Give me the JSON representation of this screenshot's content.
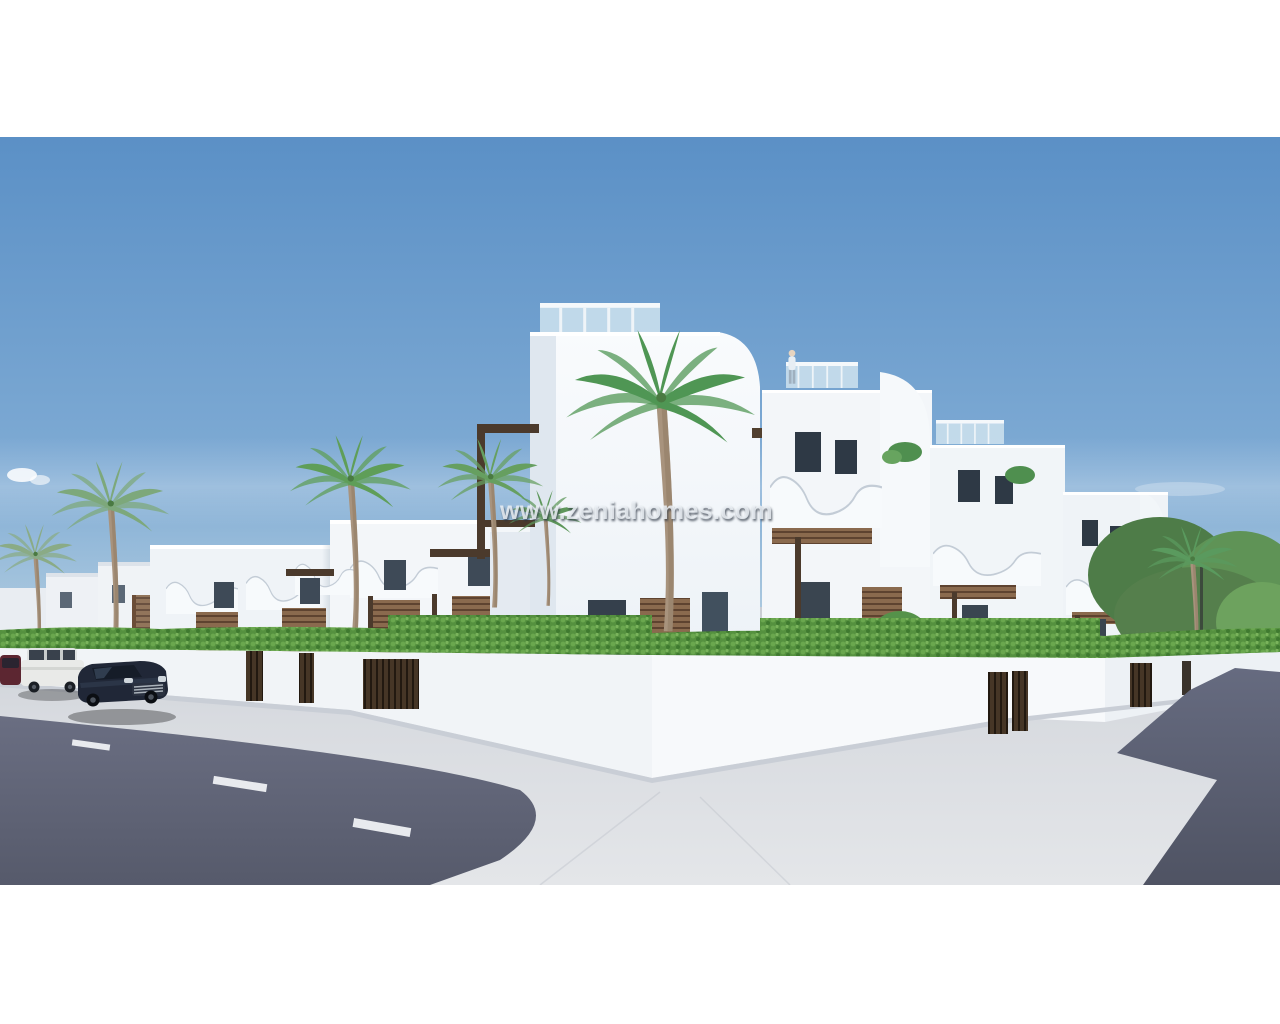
{
  "watermark": {
    "text": "www.zeniahomes.com"
  },
  "photo": {
    "type": "3d-architectural-render",
    "subject": "Modern white Mediterranean apartment complex on a street corner with palm trees, hedge-topped perimeter wall, sidewalks, asphalt roads and parked cars under a clear blue sky",
    "frame_color": "#ffffff"
  },
  "palette": {
    "sky_top": "#5b90c6",
    "sky_horizon": "#b9d2e5",
    "building_white": "#f5f8fb",
    "building_shade": "#dfe6ee",
    "glass_balustrade": "#cfe3ee",
    "wood_slats": "#8a6a4e",
    "pergola_dark": "#4b3a2c",
    "hedge_green": "#55913f",
    "asphalt": "#62667a",
    "sidewalk": "#dadde2",
    "sedan_black": "#202737",
    "suv_white": "#e9eae8",
    "car_maroon": "#5c2631"
  },
  "scene": {
    "elements": [
      "sky",
      "clouds",
      "distant-buildings",
      "left-townhouses",
      "central-tower",
      "right-townhouses",
      "rooftop-person",
      "palm-trees",
      "perimeter-wall",
      "hedge",
      "gates",
      "sidewalk",
      "road-left",
      "road-right",
      "parked-cars",
      "lane-markings"
    ]
  }
}
